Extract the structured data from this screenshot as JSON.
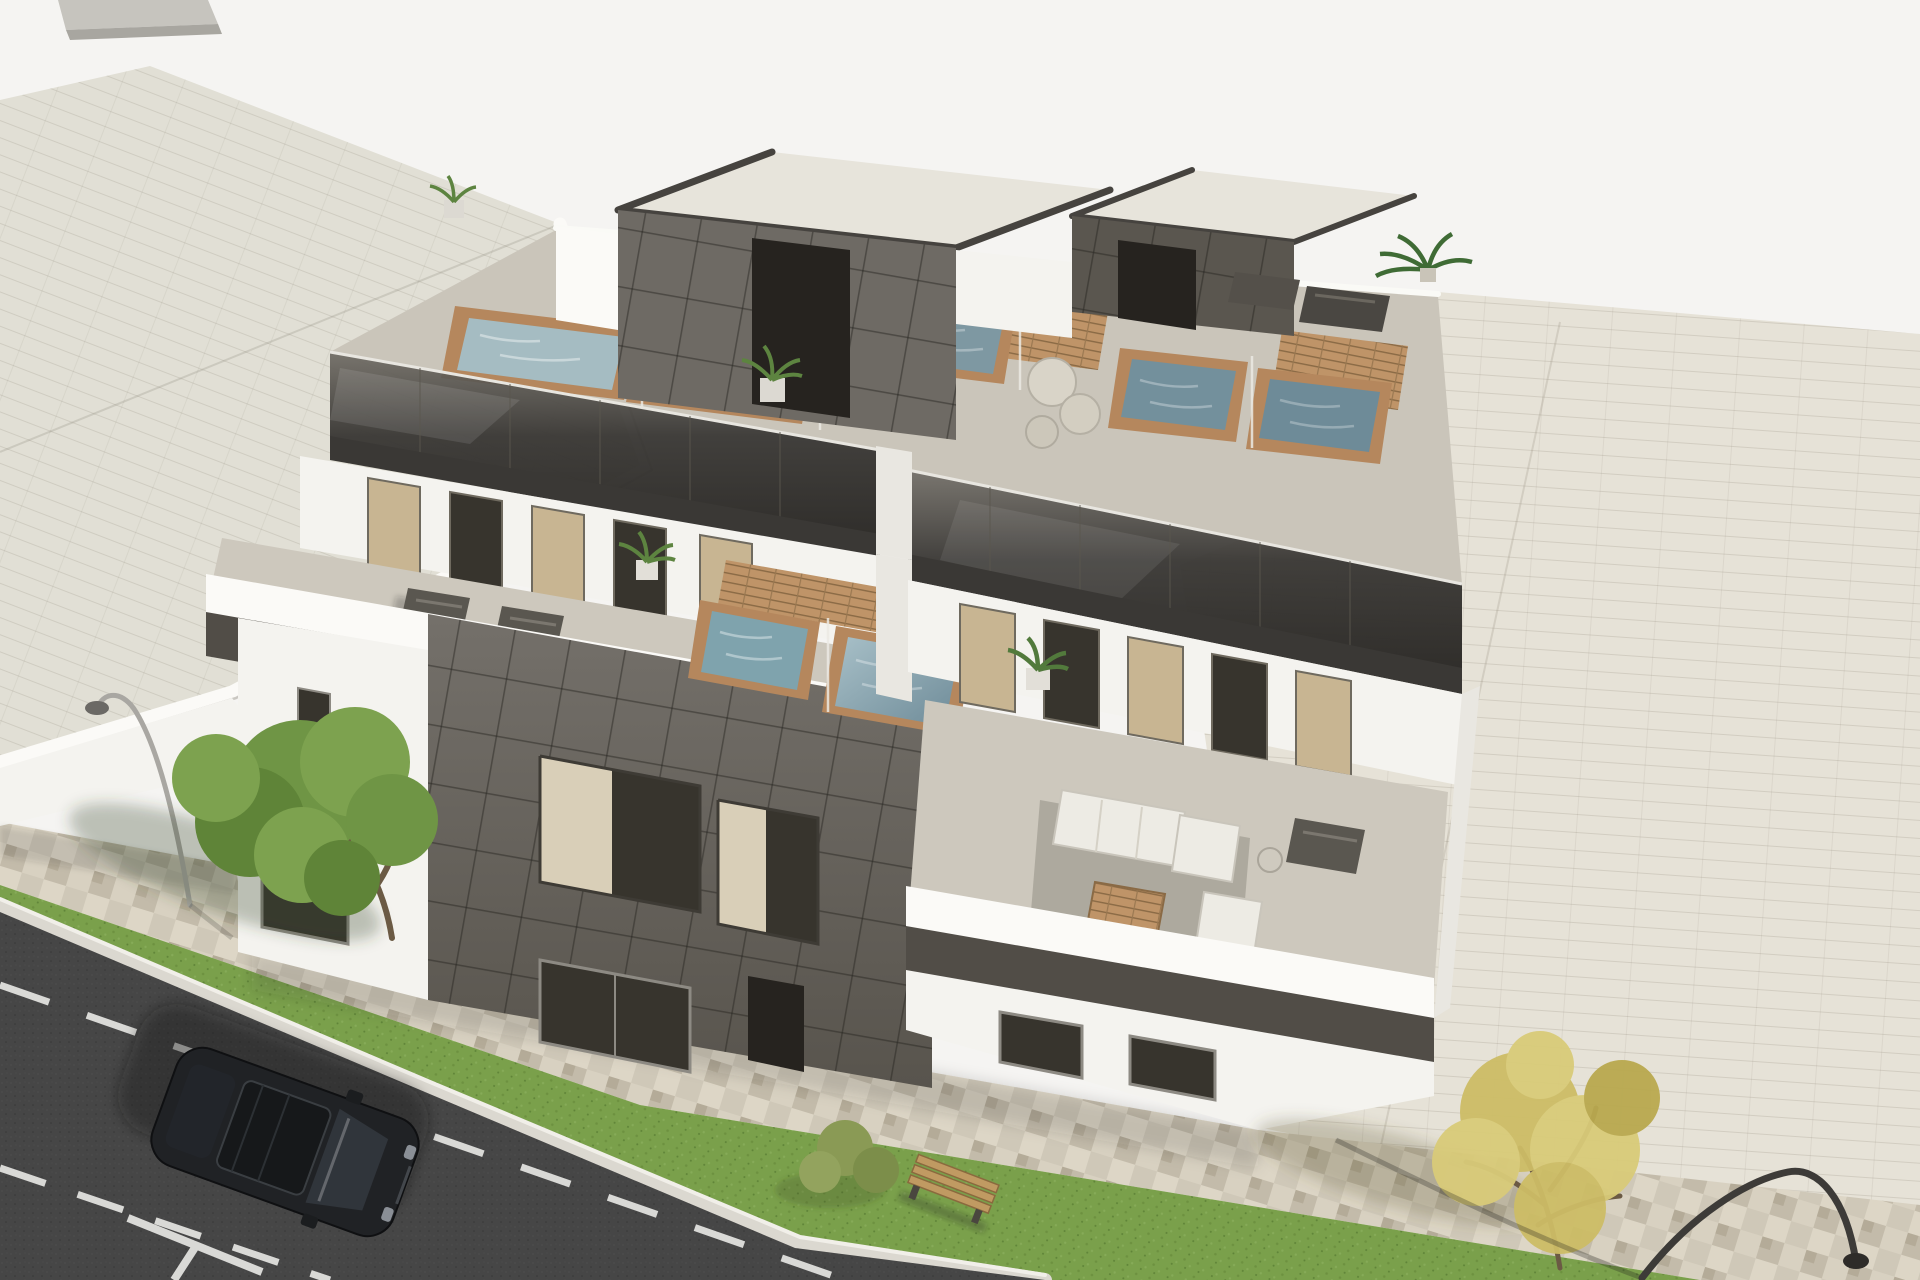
{
  "scene": {
    "title": "Aerial 3D architectural rendering of a modern two-unit residential building with rooftop plunge pools, terraces, street, parked car and trees",
    "type": "architectural-render",
    "view": "aerial-oblique bird's eye",
    "background": "plain light studio backdrop"
  },
  "palette": {
    "bg": "#f5f4f2",
    "lot": "#e6e2d7",
    "neighborRoof": "#e1dfd5",
    "wallWhite": "#f4f3ef",
    "wallBright": "#fbfaf7",
    "wallShade": "#e9e7e1",
    "deck": "#cac5ba",
    "terrace": "#cdc8bd",
    "glassDark": "#3a3835",
    "glassMid": "#5f5b55",
    "fascia": "#514d47",
    "panel": "#6e6a64",
    "panelDark": "#5a564f",
    "penthouseRoof": "#e7e4db",
    "recess": "#26231f",
    "wood": "#bf9468",
    "woodLine": "#8a6a45",
    "poolRim": "#b5875d",
    "water1": "#a5bcc2",
    "water2": "#8fa9b2",
    "water3": "#7e98a2",
    "water4": "#73909c",
    "water5": "#6e8b98",
    "terrWater": "#7fa3ad",
    "windowTan": "#c8b592",
    "windowDark": "#37342d",
    "frame": "#8d8a83",
    "grass": "#7aa04b",
    "grassDark": "#6d9140",
    "pavement": "#d3ccbc",
    "curb": "#dbd8d0",
    "road": "#4c4c4c",
    "roadLine": "#e9e9e6",
    "carBody": "#202225",
    "carGlass": "#16181a",
    "green1": "#6f9545",
    "green2": "#7da24f",
    "green3": "#5f8438",
    "yellow1": "#cdbd66",
    "yellow2": "#d9cb79",
    "branch": "#6b5a44",
    "lampLight": "#a9a7a2",
    "lampDark": "#3d3b38",
    "bench": "#c09a62",
    "sofa": "#edebe4",
    "shadow": "rgba(55,52,46,0.30)"
  },
  "objects": {
    "main_building": {
      "floors": 3,
      "units": 2,
      "rooftop_pools": 5,
      "terrace_pools": 2,
      "penthouse": "dark panelled core with light flat roof",
      "balustrade": "smoked glass with dark fascia",
      "facade": "white render with dark grey tiled feature volume"
    },
    "neighbor_building": {
      "position": "top-left",
      "roof": "light flat roof with white parapet"
    },
    "street": {
      "road": "dark asphalt",
      "lane_marking": "white dashed line",
      "parking_mark": "white T mark",
      "sidewalk": "beige mosaic pavers",
      "grass_strips": 2,
      "curb": "light stone"
    },
    "furniture": {
      "sun_loungers": 6,
      "outdoor_sofa_set": 1,
      "coffee_table": 1,
      "poufs": 3,
      "bench": 1,
      "planters": 8
    },
    "vehicles": {
      "car": {
        "color": "black",
        "type": "SUV",
        "location": "road lower-left"
      }
    },
    "trees": [
      {
        "type": "green leafy tree",
        "location": "left sidewalk"
      },
      {
        "type": "autumn yellow tree",
        "location": "right sidewalk"
      }
    ],
    "street_lamps": 2
  }
}
